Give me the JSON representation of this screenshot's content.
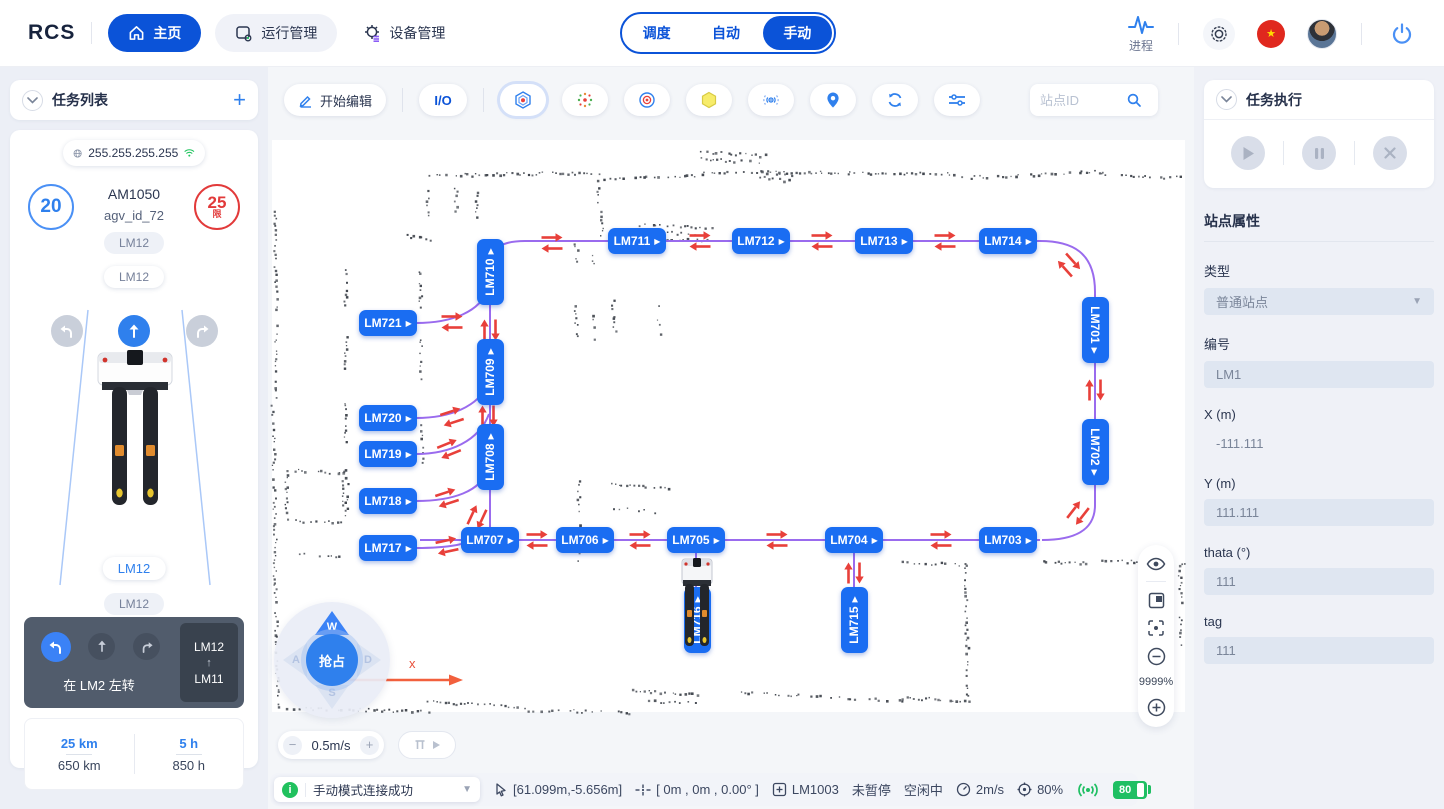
{
  "colors": {
    "accent_blue": "#0b53d8",
    "bright_blue": "#2f80ed",
    "station_blue": "#1a6df2",
    "path_purple": "#9a6bee",
    "arrow_red": "#e8403a",
    "green": "#21c15e",
    "dark_slate": "#515c6c",
    "red": "#e23a3a"
  },
  "icons": {
    "station_arrow": "▶",
    "caret_down": "▾",
    "route_arrow": "↑",
    "plus": "+",
    "star": "★",
    "info": "i",
    "minus": "−"
  },
  "navbar": {
    "logo": "RCS",
    "items": [
      {
        "label": "主页"
      },
      {
        "label": "运行管理"
      },
      {
        "label": "设备管理"
      }
    ],
    "modes": [
      "调度",
      "自动",
      "手动"
    ],
    "active_mode": "手动",
    "process_label": "进程"
  },
  "left_panel": {
    "task_list_title": "任务列表",
    "ip": "255.255.255.255",
    "speed_current": "20",
    "speed_limit": "25",
    "speed_limit_unit": "限",
    "vehicle_model": "AM1050",
    "vehicle_id": "agv_id_72",
    "station_chips": [
      "LM12",
      "LM12",
      "LM12",
      "LM12"
    ],
    "nav_hint": "在 LM2 左转",
    "route_from": "LM12",
    "route_arrow": "↑",
    "route_to": "LM11",
    "odo_today": "25 km",
    "odo_total": "650 km",
    "hours_today": "5 h",
    "hours_total": "850 h"
  },
  "map_toolbar": {
    "edit_label": "开始编辑",
    "io_label": "I/O",
    "search_placeholder": "站点ID"
  },
  "map": {
    "zoom_level": "9999%",
    "axis_label": "x",
    "speed_control": "0.5m/s",
    "joystick": {
      "center": "抢占",
      "up": "W",
      "left": "A",
      "down": "S",
      "right": "D"
    },
    "stations": [
      {
        "id": "LM710",
        "x": 490,
        "y": 272,
        "o": "v"
      },
      {
        "id": "LM709",
        "x": 490,
        "y": 372,
        "o": "v"
      },
      {
        "id": "LM708",
        "x": 490,
        "y": 457,
        "o": "v"
      },
      {
        "id": "LM721",
        "x": 388,
        "y": 323,
        "o": "h"
      },
      {
        "id": "LM720",
        "x": 388,
        "y": 418,
        "o": "h"
      },
      {
        "id": "LM719",
        "x": 388,
        "y": 454,
        "o": "h"
      },
      {
        "id": "LM718",
        "x": 388,
        "y": 501,
        "o": "h"
      },
      {
        "id": "LM717",
        "x": 388,
        "y": 548,
        "o": "h"
      },
      {
        "id": "LM711",
        "x": 637,
        "y": 241,
        "o": "h"
      },
      {
        "id": "LM712",
        "x": 761,
        "y": 241,
        "o": "h"
      },
      {
        "id": "LM713",
        "x": 884,
        "y": 241,
        "o": "h"
      },
      {
        "id": "LM714",
        "x": 1008,
        "y": 241,
        "o": "h"
      },
      {
        "id": "LM701",
        "x": 1095,
        "y": 330,
        "o": "vd"
      },
      {
        "id": "LM702",
        "x": 1095,
        "y": 452,
        "o": "vd"
      },
      {
        "id": "LM707",
        "x": 490,
        "y": 540,
        "o": "h"
      },
      {
        "id": "LM706",
        "x": 585,
        "y": 540,
        "o": "h"
      },
      {
        "id": "LM705",
        "x": 696,
        "y": 540,
        "o": "h"
      },
      {
        "id": "LM704",
        "x": 854,
        "y": 540,
        "o": "h"
      },
      {
        "id": "LM703",
        "x": 1008,
        "y": 540,
        "o": "h"
      },
      {
        "id": "LM716",
        "x": 697,
        "y": 620,
        "o": "v"
      },
      {
        "id": "LM715",
        "x": 854,
        "y": 620,
        "o": "v"
      }
    ]
  },
  "status_bar": {
    "message": "手动模式连接成功",
    "cursor_coords": "[61.099m,-5.656m]",
    "pose": "[ 0m , 0m , 0.00° ]",
    "station": "LM1003",
    "pause_state": "未暂停",
    "idle_state": "空闲中",
    "speed": "2m/s",
    "percent": "80%",
    "battery": "80"
  },
  "right_panel": {
    "task_exec_title": "任务执行",
    "props_title": "站点属性",
    "fields": [
      {
        "key": "type",
        "label": "类型",
        "value": "普通站点",
        "control": "select"
      },
      {
        "key": "code",
        "label": "编号",
        "value": "LM1",
        "control": "input"
      },
      {
        "key": "x",
        "label": "X (m)",
        "value": "-111.111",
        "control": "plain"
      },
      {
        "key": "y",
        "label": "Y (m)",
        "value": "111.111",
        "control": "input"
      },
      {
        "key": "theta",
        "label": "thata (°)",
        "value": "111",
        "control": "input"
      },
      {
        "key": "tag",
        "label": "tag",
        "value": "111",
        "control": "input"
      }
    ]
  }
}
